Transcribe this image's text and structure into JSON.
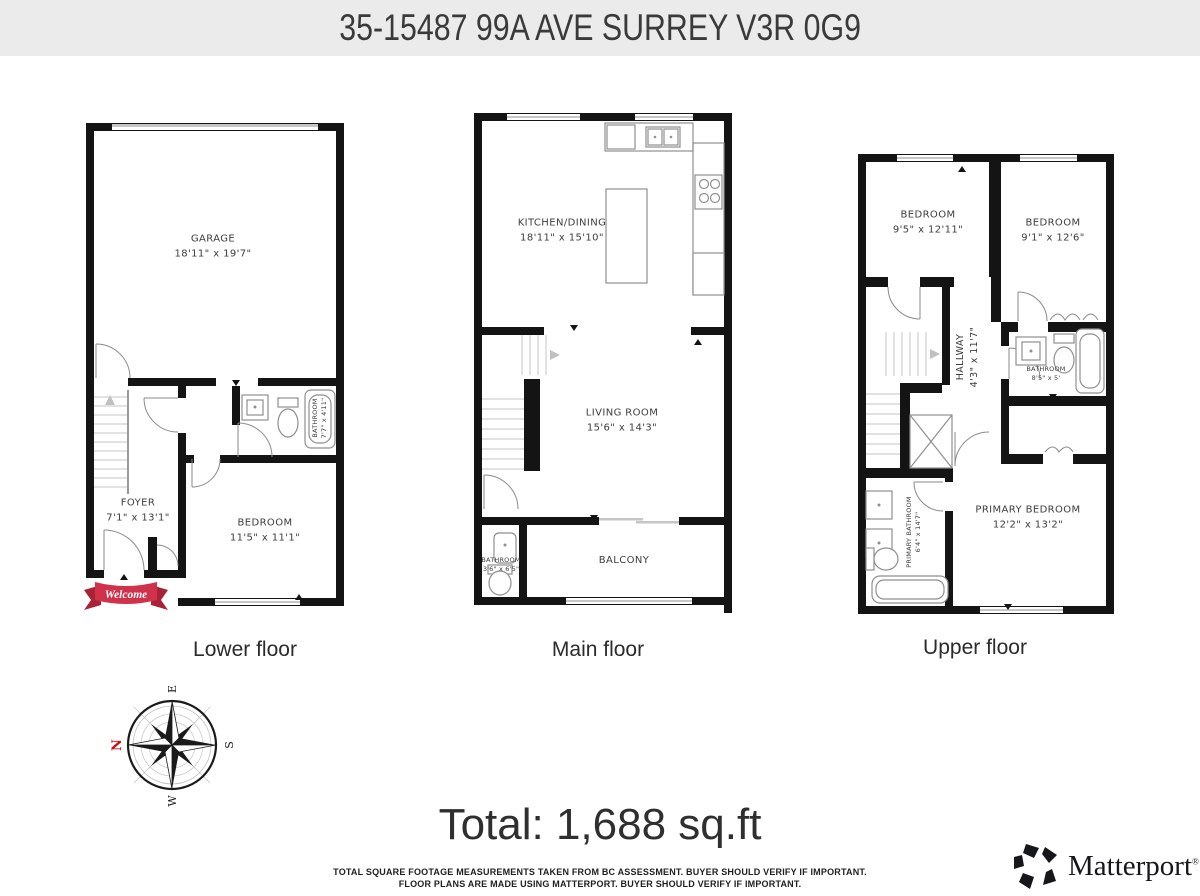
{
  "header": {
    "title": "35-15487 99A AVE SURREY V3R 0G9"
  },
  "floors": [
    {
      "label": "Lower floor",
      "rooms": {
        "garage": {
          "name": "GARAGE",
          "dims": "18'11\" x 19'7\""
        },
        "foyer": {
          "name": "FOYER",
          "dims": "7'1\" x 13'1\""
        },
        "bedroom": {
          "name": "BEDROOM",
          "dims": "11'5\" x 11'1\""
        },
        "bathroom": {
          "name": "BATHROOM",
          "dims": "7'7\" x 4'11\""
        }
      }
    },
    {
      "label": "Main floor",
      "rooms": {
        "kitchen_dining": {
          "name": "KITCHEN/DINING",
          "dims": "18'11\" x 15'10\""
        },
        "living_room": {
          "name": "LIVING ROOM",
          "dims": "15'6\" x 14'3\""
        },
        "balcony": {
          "name": "BALCONY",
          "dims": ""
        },
        "bathroom": {
          "name": "BATHROOM",
          "dims": "3'6\" x 6'5\""
        }
      }
    },
    {
      "label": "Upper floor",
      "rooms": {
        "bedroom_left": {
          "name": "BEDROOM",
          "dims": "9'5\" x 12'11\""
        },
        "bedroom_right": {
          "name": "BEDROOM",
          "dims": "9'1\" x 12'6\""
        },
        "hallway": {
          "name": "HALLWAY",
          "dims": "4'3\" x 11'7\""
        },
        "bathroom": {
          "name": "BATHROOM",
          "dims": "8'5\" x 5'"
        },
        "primary_bathroom": {
          "name": "PRIMARY BATHROOM",
          "dims": "6'4\" x 14'7\""
        },
        "primary_bedroom": {
          "name": "PRIMARY BEDROOM",
          "dims": "12'2\" x 13'2\""
        }
      }
    }
  ],
  "banner": {
    "welcome_label": "Welcome",
    "ribbon_color": "#d0314b"
  },
  "compass": {
    "n": "N",
    "e": "E",
    "s": "S",
    "w": "W",
    "north_color": "#cc1111"
  },
  "total": {
    "text": "Total: 1,688 sq.ft"
  },
  "disclaimer": {
    "line1": "TOTAL SQUARE FOOTAGE MEASUREMENTS TAKEN FROM BC ASSESSMENT. BUYER SHOULD VERIFY IF IMPORTANT.",
    "line2": "FLOOR PLANS ARE MADE USING MATTERPORT. BUYER SHOULD VERIFY IF IMPORTANT."
  },
  "brand": {
    "name": "Matterport",
    "registered": "®"
  },
  "colors": {
    "wall": "#141414",
    "header_bg": "#ebebeb"
  }
}
